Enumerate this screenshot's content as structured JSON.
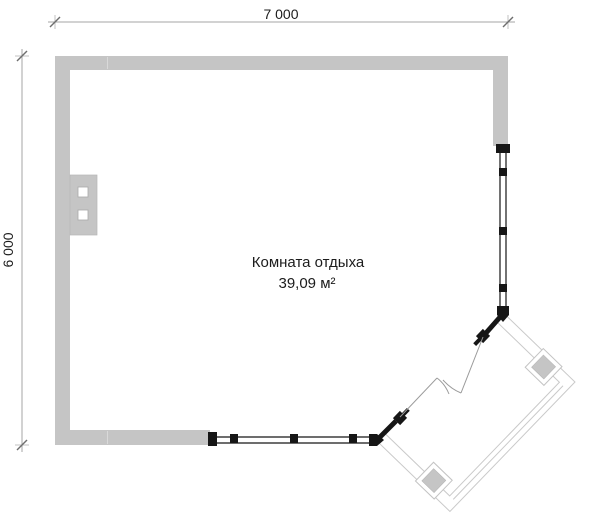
{
  "drawing": {
    "type": "floor-plan"
  },
  "dimensions": {
    "width": {
      "label": "7 000"
    },
    "height": {
      "label": "6 000"
    }
  },
  "room": {
    "name": "Комната отдыха",
    "area": "39,09 м²"
  },
  "colors": {
    "wall_fill": "#c5c5c5",
    "frame_black": "#161616",
    "terrace_line": "#c9c9c9",
    "column_fill": "#c5c5c5",
    "dimension_line": "#a6a6a6",
    "door_leaf_line": "#9b9b9b",
    "text": "#1c1c1c",
    "background": "#ffffff"
  }
}
